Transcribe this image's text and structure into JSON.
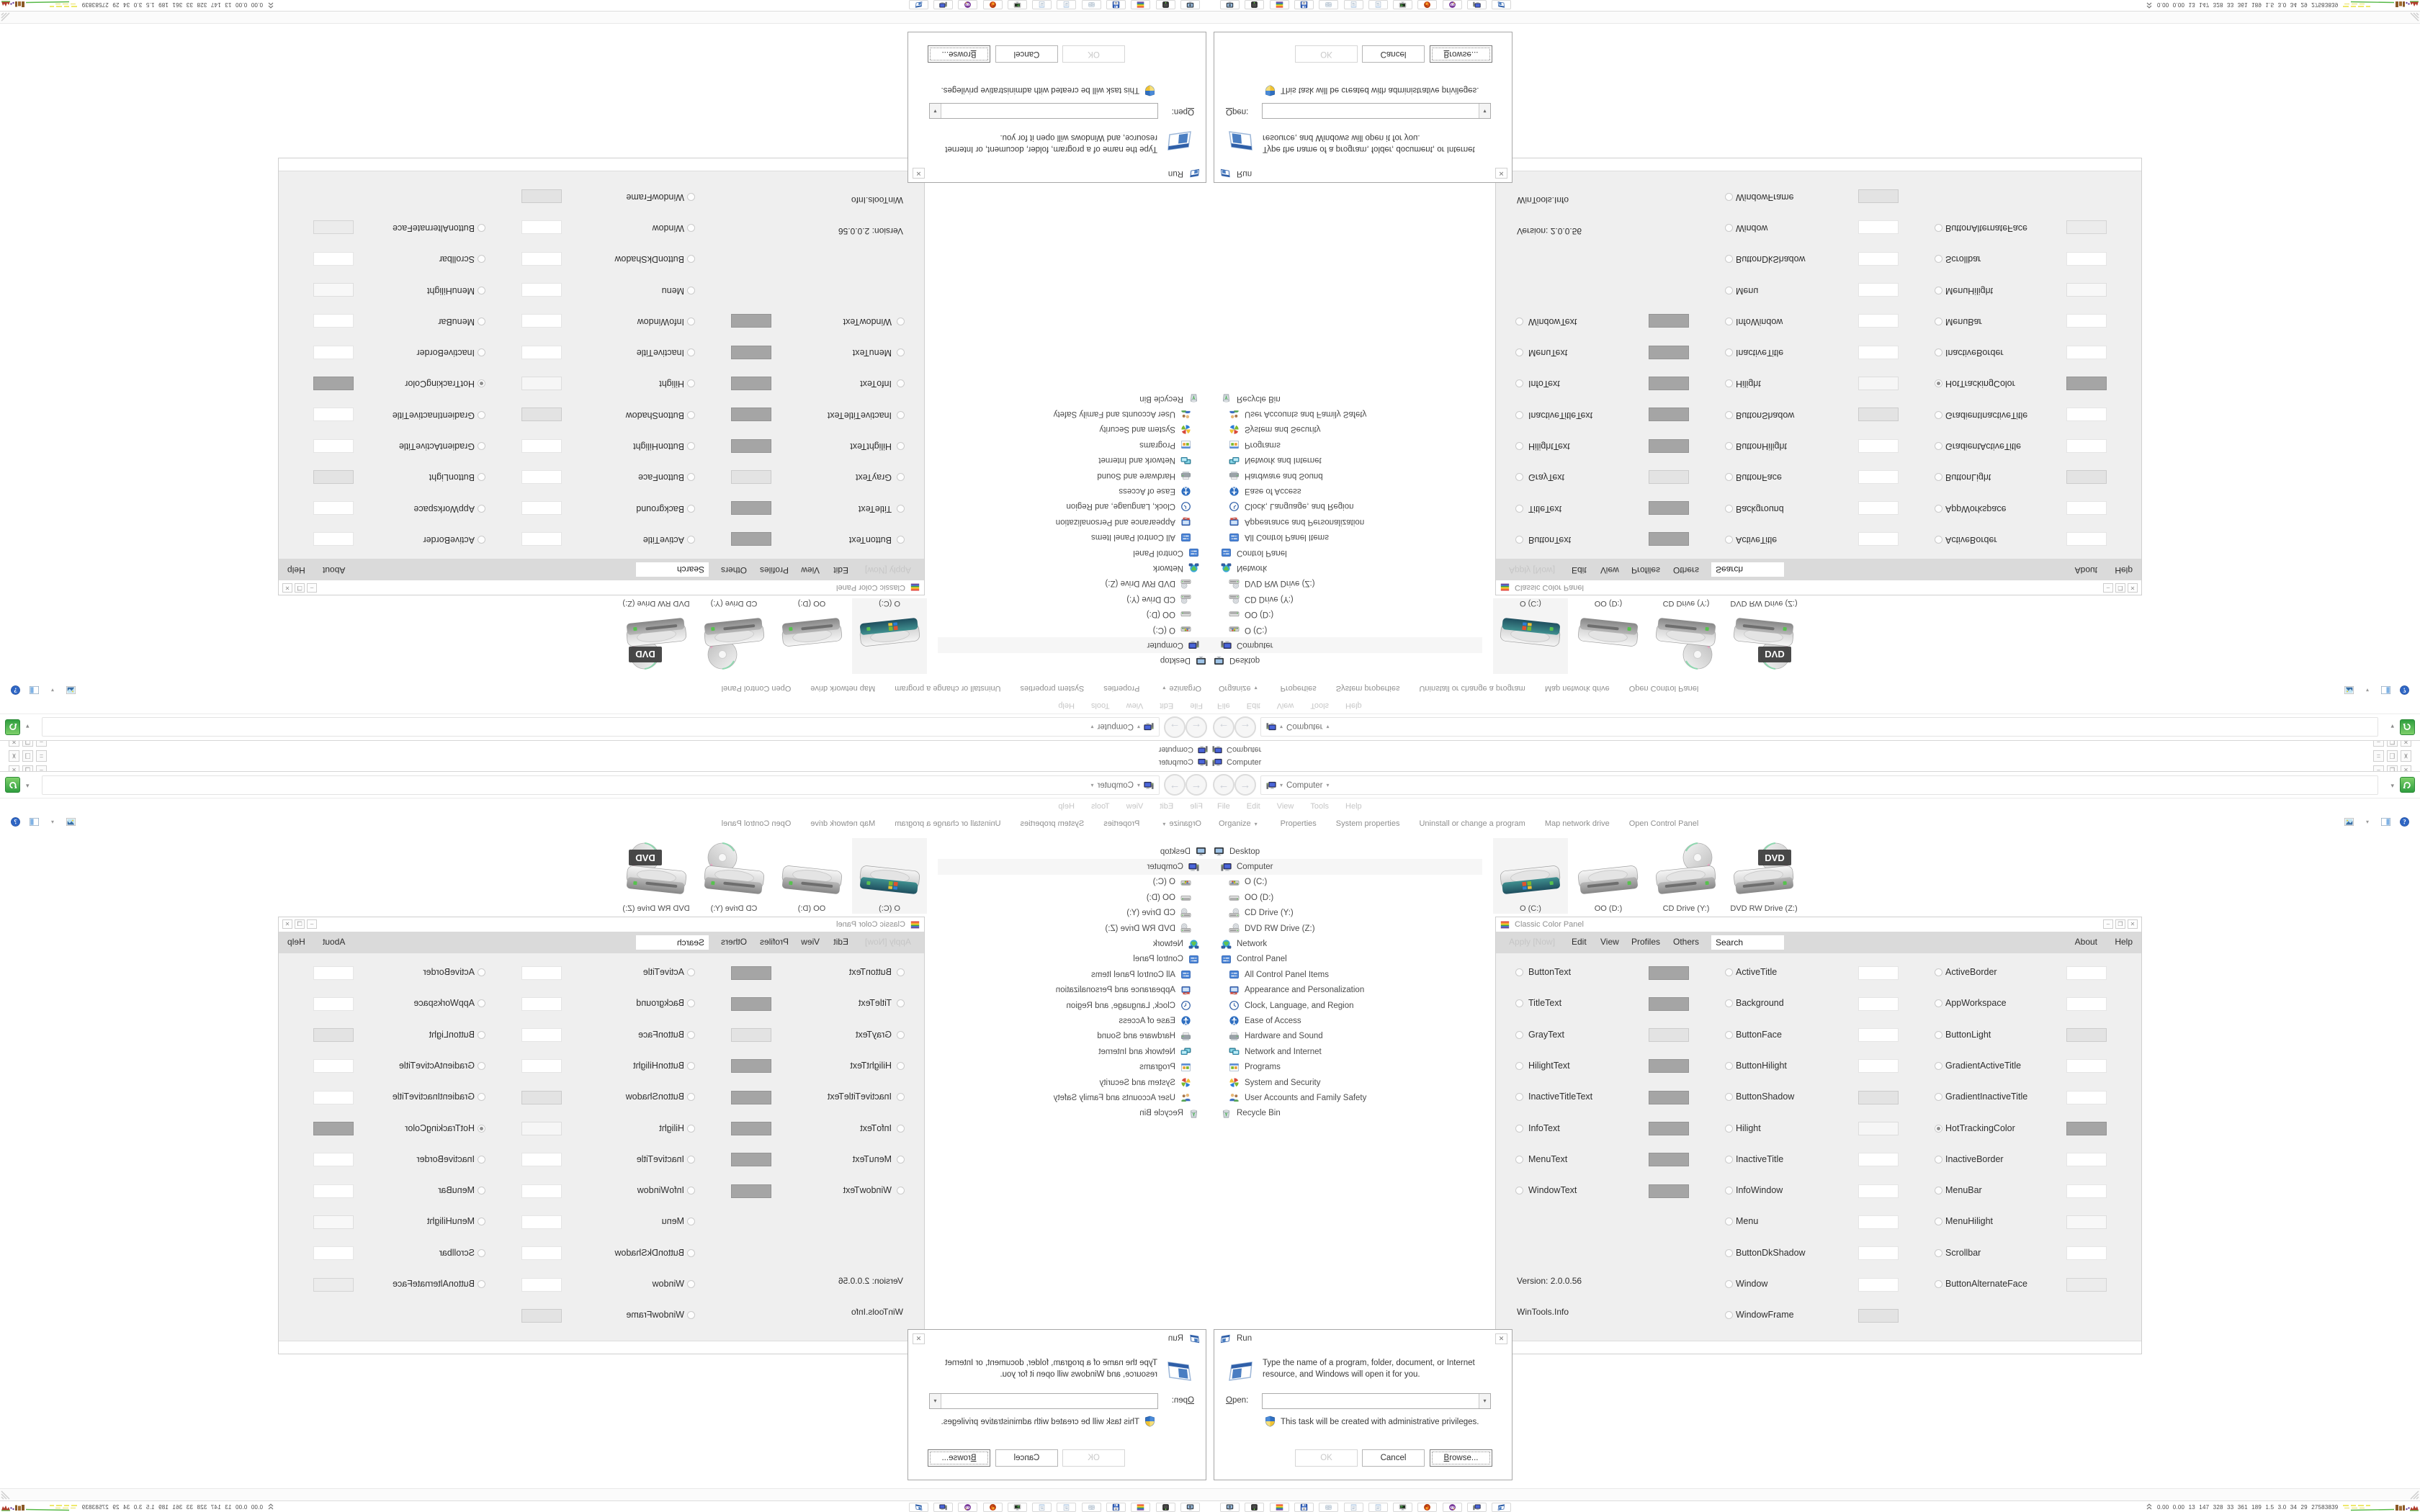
{
  "back_windows": {
    "tree_item_label": "Computer",
    "caption_minimize": "–",
    "caption_restore": "❐",
    "caption_close": "✕"
  },
  "explorer": {
    "address_location": "Computer",
    "dropdown_glyph": "▾",
    "back_glyph": "←",
    "forward_glyph": "→",
    "menu_items": [
      "File",
      "Edit",
      "View",
      "Tools",
      "Help"
    ],
    "command_items": [
      "Organize",
      "Properties",
      "System properties",
      "Uninstall or change a program",
      "Map network drive",
      "Open Control Panel"
    ],
    "tree": [
      {
        "label": "Desktop",
        "icon": "desktop-icon",
        "depth": 0
      },
      {
        "label": "Computer",
        "icon": "computer-icon",
        "depth": 1,
        "selected": true
      },
      {
        "label": "O (C:)",
        "icon": "drive-windows-icon",
        "depth": 2
      },
      {
        "label": "OO (D:)",
        "icon": "drive-icon",
        "depth": 2
      },
      {
        "label": "CD Drive (Y:)",
        "icon": "cd-drive-icon",
        "depth": 2
      },
      {
        "label": "DVD RW Drive (Z:)",
        "icon": "cd-drive-icon",
        "depth": 2
      },
      {
        "label": "Network",
        "icon": "network-icon",
        "depth": 1
      },
      {
        "label": "Control Panel",
        "icon": "control-panel-icon",
        "depth": 1
      },
      {
        "label": "All Control Panel Items",
        "icon": "control-panel-icon",
        "depth": 2
      },
      {
        "label": "Appearance and Personalization",
        "icon": "appearance-icon",
        "depth": 2
      },
      {
        "label": "Clock, Language, and Region",
        "icon": "clock-icon",
        "depth": 2
      },
      {
        "label": "Ease of Access",
        "icon": "ease-icon",
        "depth": 2
      },
      {
        "label": "Hardware and Sound",
        "icon": "hardware-icon",
        "depth": 2
      },
      {
        "label": "Network and Internet",
        "icon": "network-internet-icon",
        "depth": 2
      },
      {
        "label": "Programs",
        "icon": "programs-icon",
        "depth": 2
      },
      {
        "label": "System and Security",
        "icon": "security-icon",
        "depth": 2
      },
      {
        "label": "User Accounts and Family Safety",
        "icon": "users-icon",
        "depth": 2
      },
      {
        "label": "Recycle Bin",
        "icon": "recycle-icon",
        "depth": 1
      }
    ],
    "drives": [
      {
        "label": "O (C:)",
        "kind": "windows",
        "selected": true
      },
      {
        "label": "OO (D:)",
        "kind": "plain"
      },
      {
        "label": "CD Drive (Y:)",
        "kind": "cd"
      },
      {
        "label": "DVD RW Drive (Z:)",
        "kind": "dvd"
      }
    ]
  },
  "ccp": {
    "title": "Classic Color Panel",
    "apply_label": "Apply [Now]",
    "menu_items": [
      "Edit",
      "View",
      "Profiles",
      "Others"
    ],
    "search_value": "Search",
    "about_label": "About",
    "help_label": "Help",
    "version": "Version: 2.0.0.56",
    "site": "WinTools.Info",
    "bottom_glyph": "x",
    "col1": [
      {
        "label": "ButtonText",
        "color": "#a5a5a5"
      },
      {
        "label": "TitleText",
        "color": "#a5a5a5"
      },
      {
        "label": "GrayText",
        "color": "#e3e3e3"
      },
      {
        "label": "HilightText",
        "color": "#a5a5a5"
      },
      {
        "label": "InactiveTitleText",
        "color": "#a5a5a5"
      },
      {
        "label": "InfoText",
        "color": "#a5a5a5"
      },
      {
        "label": "MenuText",
        "color": "#a5a5a5"
      },
      {
        "label": "WindowText",
        "color": "#a5a5a5"
      }
    ],
    "col2": [
      {
        "label": "ActiveTitle",
        "color": "#ffffff"
      },
      {
        "label": "Background",
        "color": "#ffffff"
      },
      {
        "label": "ButtonFace",
        "color": "#ffffff"
      },
      {
        "label": "ButtonHilight",
        "color": "#ffffff"
      },
      {
        "label": "ButtonShadow",
        "color": "#e3e3e3"
      },
      {
        "label": "Hilight",
        "color": "#f6f6f6"
      },
      {
        "label": "InactiveTitle",
        "color": "#ffffff"
      },
      {
        "label": "InfoWindow",
        "color": "#ffffff"
      },
      {
        "label": "Menu",
        "color": "#ffffff"
      },
      {
        "label": "ButtonDkShadow",
        "color": "#ffffff"
      },
      {
        "label": "Window",
        "color": "#ffffff"
      },
      {
        "label": "WindowFrame",
        "color": "#e3e3e3"
      }
    ],
    "col3": [
      {
        "label": "ActiveBorder",
        "color": "#ffffff"
      },
      {
        "label": "AppWorkspace",
        "color": "#ffffff"
      },
      {
        "label": "ButtonLight",
        "color": "#e3e3e3"
      },
      {
        "label": "GradientActiveTitle",
        "color": "#ffffff"
      },
      {
        "label": "GradientInactiveTitle",
        "color": "#ffffff"
      },
      {
        "label": "HotTrackingColor",
        "color": "#a5a5a5",
        "selected": true
      },
      {
        "label": "InactiveBorder",
        "color": "#ffffff"
      },
      {
        "label": "MenuBar",
        "color": "#ffffff"
      },
      {
        "label": "MenuHilight",
        "color": "#f8f8f8"
      },
      {
        "label": "Scrollbar",
        "color": "#ffffff"
      },
      {
        "label": "ButtonAlternateFace",
        "color": "#ececec"
      }
    ]
  },
  "run_dialog": {
    "title": "Run",
    "description_line1": "Type the name of a program, folder, document, or Internet",
    "description_line2": "resource, and Windows will open it for you.",
    "open_label": "Open:",
    "admin_note": "This task will be created with administrative privileges.",
    "ok_label": "OK",
    "cancel_label": "Cancel",
    "browse_label": "Browse...",
    "close_glyph": "✕"
  },
  "taskbar": {
    "buttons": [
      {
        "icon": "monitor-camera-icon"
      },
      {
        "icon": "device-led-icon"
      },
      {
        "icon": "rainbow-icon"
      },
      {
        "icon": "floppy64-icon"
      },
      {
        "icon": "scroll-icon"
      },
      {
        "icon": "notepad-icon"
      },
      {
        "icon": "notepad-icon"
      },
      {
        "icon": "console-icon"
      },
      {
        "icon": "firefox-icon"
      },
      {
        "icon": "purple-mask-icon"
      },
      {
        "icon": "computer-icon"
      },
      {
        "icon": "run-icon"
      }
    ],
    "tray_stats": "0.00 0.00  13  147  328  33  361  189  1.5  3.0  34  29  27583839"
  },
  "colors": {
    "accent_green": "#2f9e3f",
    "graph_yellow": "#e8e23a",
    "graph_green": "#57b947",
    "graph_brown": "#8a5a28",
    "graph_red": "#b03a2a",
    "ccp_body": "#efefef",
    "ccp_menu": "#dadada",
    "swatch_gray": "#a5a5a5"
  }
}
